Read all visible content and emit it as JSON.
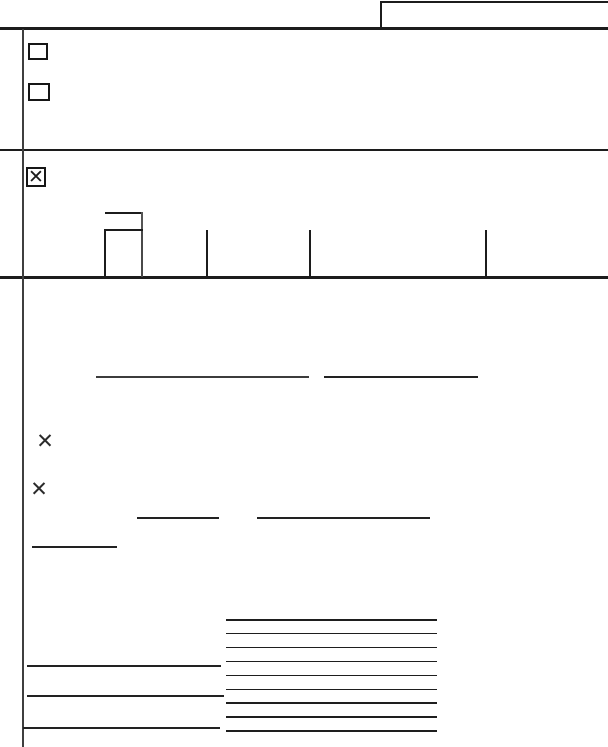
{
  "document": {
    "description": "Blank scanned form page: line work, checkboxes and X marks only; no printed text visible",
    "paper_color": "#ffffff",
    "ink_color": "#1c1c1c"
  },
  "checkboxes": [
    {
      "name": "top-checkbox-1",
      "checked": false,
      "glyph": ""
    },
    {
      "name": "top-checkbox-2",
      "checked": false,
      "glyph": ""
    },
    {
      "name": "section-checkbox",
      "checked": true,
      "glyph": "✕"
    }
  ],
  "marks": [
    {
      "name": "x-mark-1",
      "glyph": "✕"
    },
    {
      "name": "x-mark-2",
      "glyph": "✕"
    }
  ],
  "ruled_area": {
    "line_count": 9,
    "line_spacing_px": 13.9
  }
}
